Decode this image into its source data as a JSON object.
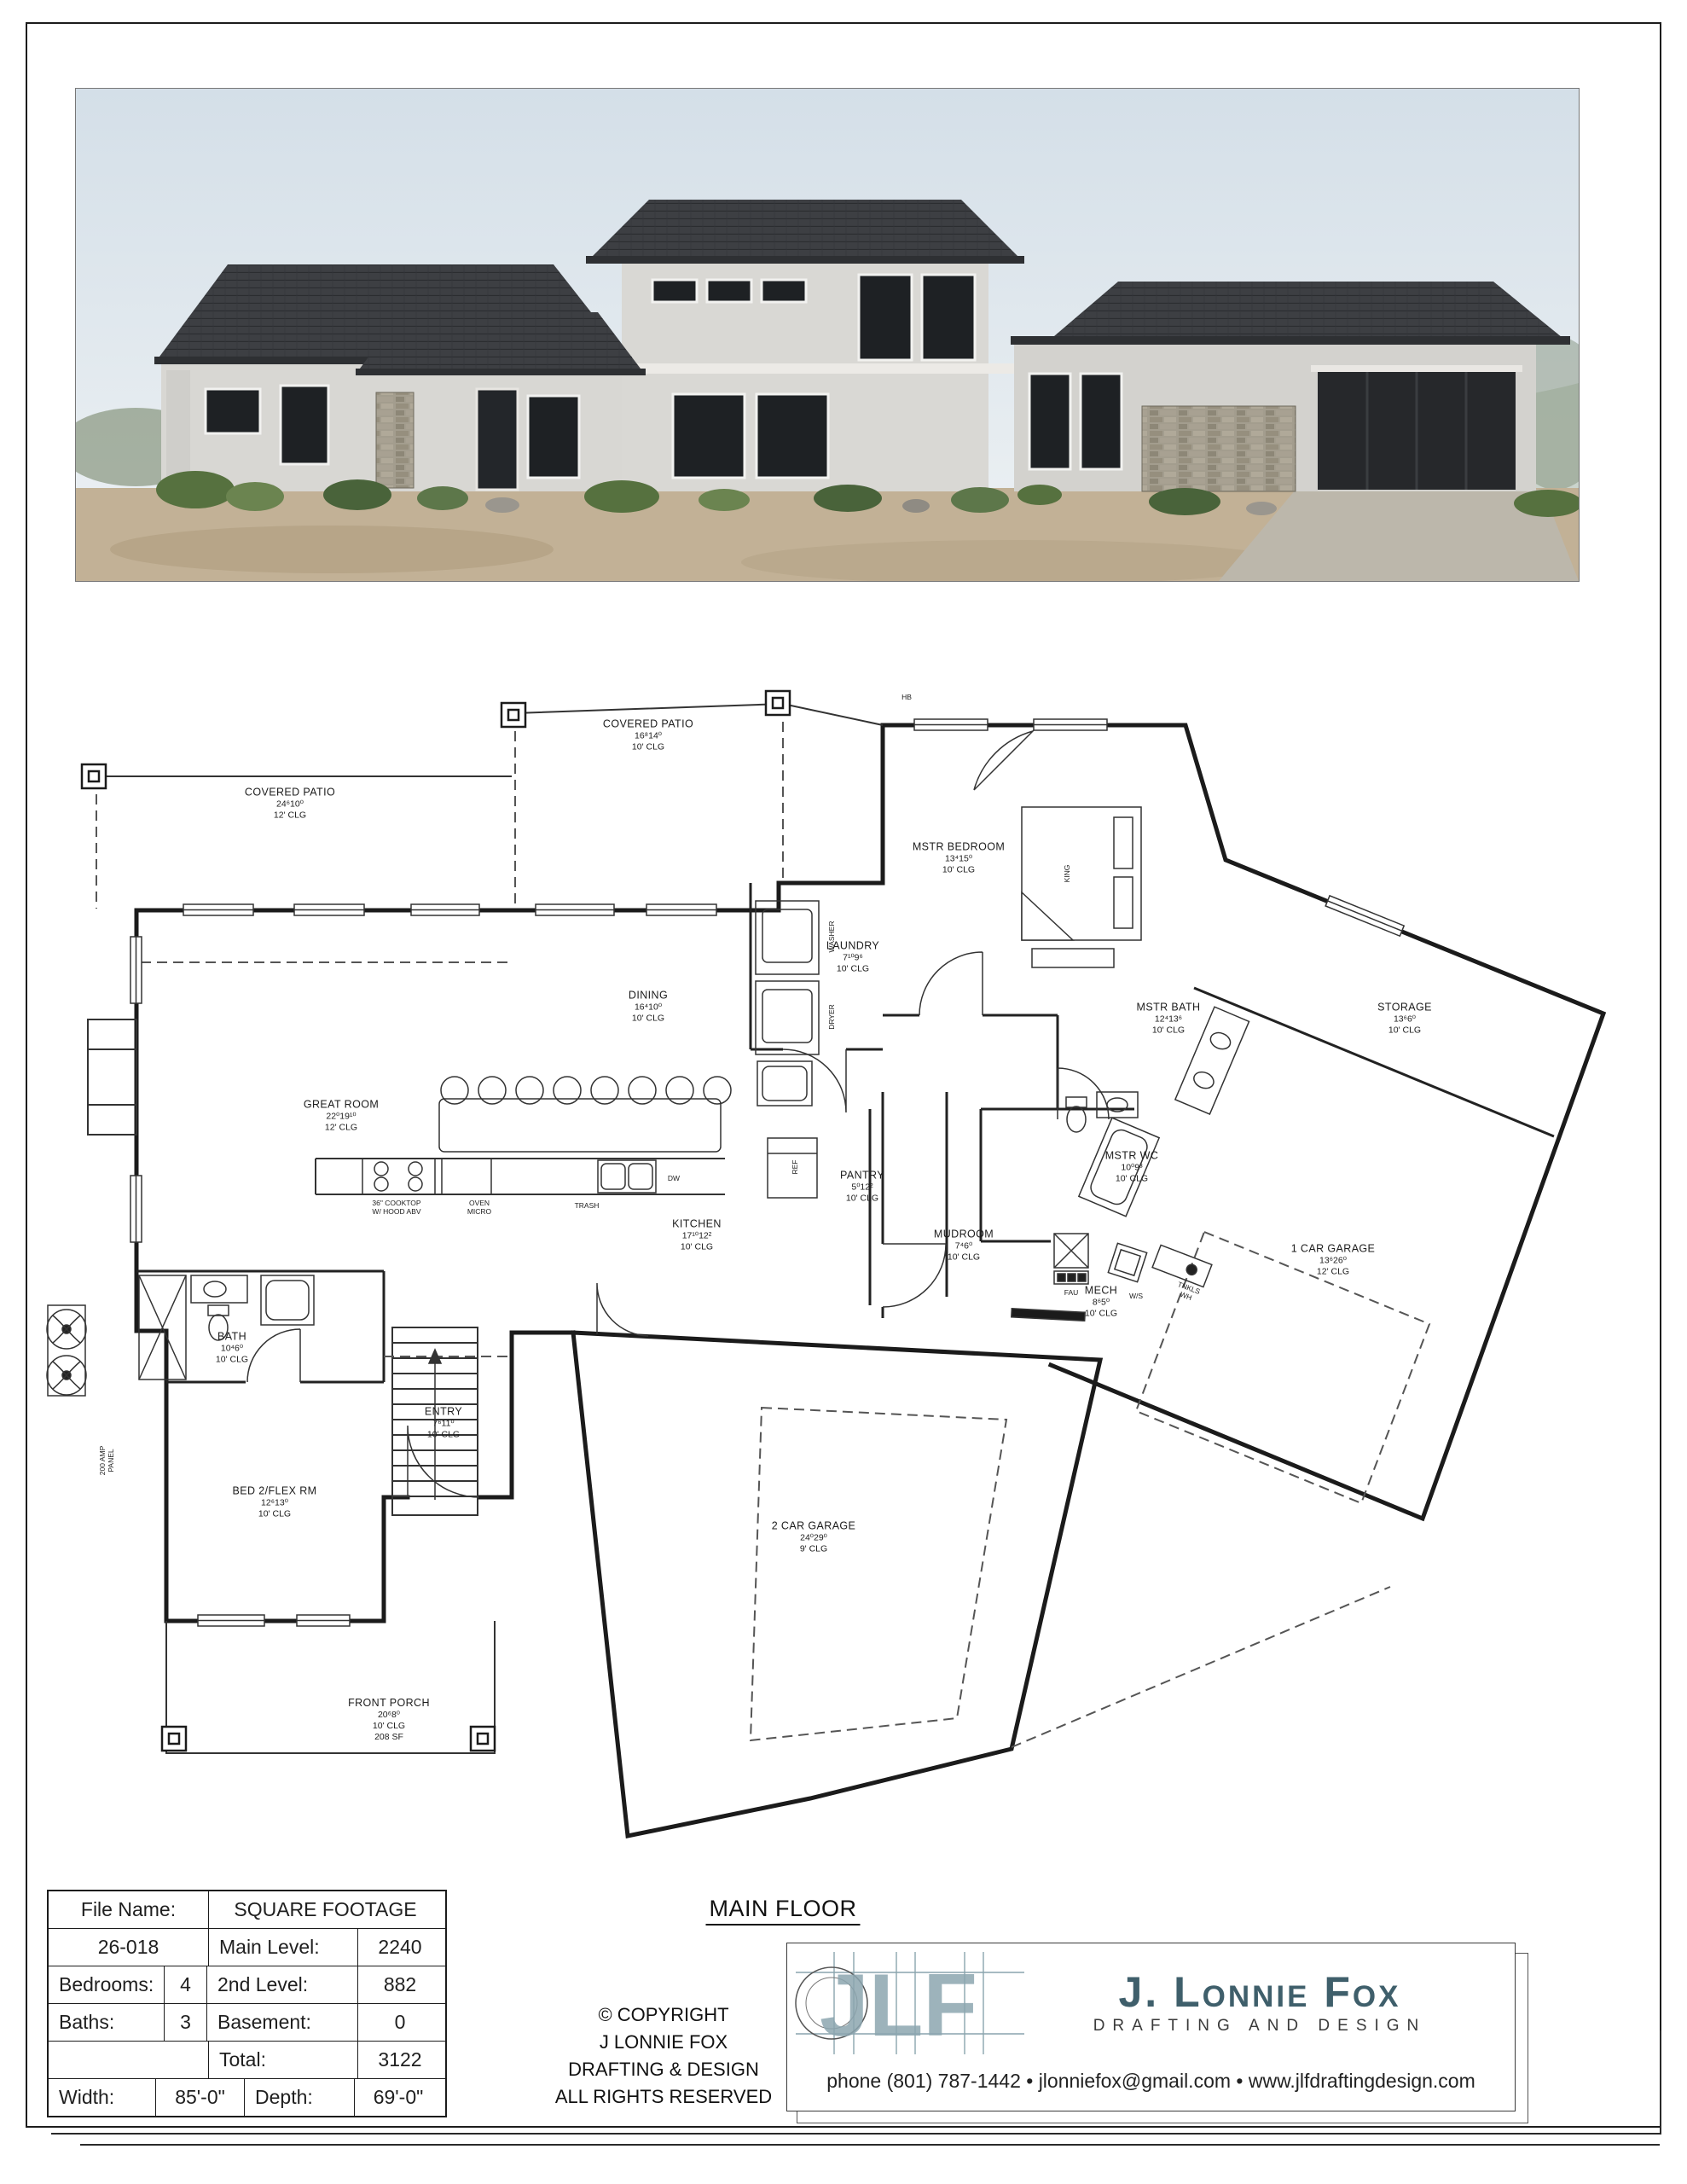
{
  "plan": {
    "title": "MAIN FLOOR",
    "rooms": [
      {
        "id": "covered-patio-left",
        "name": "COVERED PATIO",
        "dims": "24⁶10⁰",
        "clg": "12' CLG"
      },
      {
        "id": "covered-patio-top",
        "name": "COVERED PATIO",
        "dims": "16⁸14⁰",
        "clg": "10' CLG"
      },
      {
        "id": "mstr-bedroom",
        "name": "MSTR BEDROOM",
        "dims": "13⁴15⁰",
        "clg": "10' CLG"
      },
      {
        "id": "laundry",
        "name": "LAUNDRY",
        "dims": "7¹⁰9⁶",
        "clg": "10' CLG"
      },
      {
        "id": "dining",
        "name": "DINING",
        "dims": "16⁴10⁰",
        "clg": "10' CLG"
      },
      {
        "id": "great-room",
        "name": "GREAT ROOM",
        "dims": "22⁰19¹⁰",
        "clg": "12' CLG"
      },
      {
        "id": "mstr-bath",
        "name": "MSTR BATH",
        "dims": "12⁴13⁶",
        "clg": "10' CLG"
      },
      {
        "id": "storage",
        "name": "STORAGE",
        "dims": "13⁶6⁰",
        "clg": "10' CLG"
      },
      {
        "id": "mstr-wc",
        "name": "MSTR WC",
        "dims": "10⁰9³",
        "clg": "10' CLG"
      },
      {
        "id": "kitchen",
        "name": "KITCHEN",
        "dims": "17¹⁰12²",
        "clg": "10' CLG"
      },
      {
        "id": "pantry",
        "name": "PANTRY",
        "dims": "5⁰12²",
        "clg": "10' CLG"
      },
      {
        "id": "mudroom",
        "name": "MUDROOM",
        "dims": "7⁴6⁰",
        "clg": "10' CLG"
      },
      {
        "id": "mech",
        "name": "MECH",
        "dims": "8⁶5⁰",
        "clg": "10' CLG"
      },
      {
        "id": "one-car-garage",
        "name": "1 CAR GARAGE",
        "dims": "13⁶26⁰",
        "clg": "12' CLG"
      },
      {
        "id": "two-car-garage",
        "name": "2 CAR GARAGE",
        "dims": "24⁰29⁰",
        "clg": "9' CLG"
      },
      {
        "id": "bath",
        "name": "BATH",
        "dims": "10⁴6⁰",
        "clg": "10' CLG"
      },
      {
        "id": "entry",
        "name": "ENTRY",
        "dims": "7⁶11⁰",
        "clg": "10' CLG"
      },
      {
        "id": "bed2-flex",
        "name": "BED 2/FLEX RM",
        "dims": "12⁶13⁰",
        "clg": "10' CLG"
      },
      {
        "id": "front-porch",
        "name": "FRONT PORCH",
        "dims": "20⁶8⁰",
        "clg": "10' CLG",
        "extra": "208 SF"
      }
    ],
    "small": {
      "washer": "WASHER",
      "dryer": "DRYER",
      "dw": "DW",
      "ref": "REF",
      "trash": "TRASH",
      "fau": "FAU",
      "ws": "W/S",
      "tnkls1": "TNKLS",
      "tnkls2": "WH",
      "panel1": "200 AMP",
      "panel2": "PANEL",
      "hb": "HB",
      "king": "KING",
      "cook1": "36\" COOKTOP",
      "cook2": "W/ HOOD ABV",
      "oven": "OVEN",
      "micro": "MICRO"
    }
  },
  "title_block": {
    "file_name_label": "File Name:",
    "file_name": "26-018",
    "bedrooms_label": "Bedrooms:",
    "bedrooms": "4",
    "baths_label": "Baths:",
    "baths": "3",
    "width_label": "Width:",
    "width": "85'-0\"",
    "depth_label": "Depth:",
    "depth": "69'-0\"",
    "sf_header": "SQUARE FOOTAGE",
    "main_label": "Main Level:",
    "main": "2240",
    "second_label": "2nd Level:",
    "second": "882",
    "basement_label": "Basement:",
    "basement": "0",
    "total_label": "Total:",
    "total": "3122"
  },
  "copyright": {
    "line1": "© COPYRIGHT",
    "line2": "J LONNIE FOX",
    "line3": "DRAFTING & DESIGN",
    "line4": "ALL RIGHTS RESERVED"
  },
  "logo": {
    "monogram": "JLF",
    "name": "J. Lonnie Fox",
    "tagline": "DRAFTING AND DESIGN",
    "contact": "phone (801) 787-1442 • jlonniefox@gmail.com • www.jlfdraftingdesign.com",
    "accent": "#456470"
  }
}
